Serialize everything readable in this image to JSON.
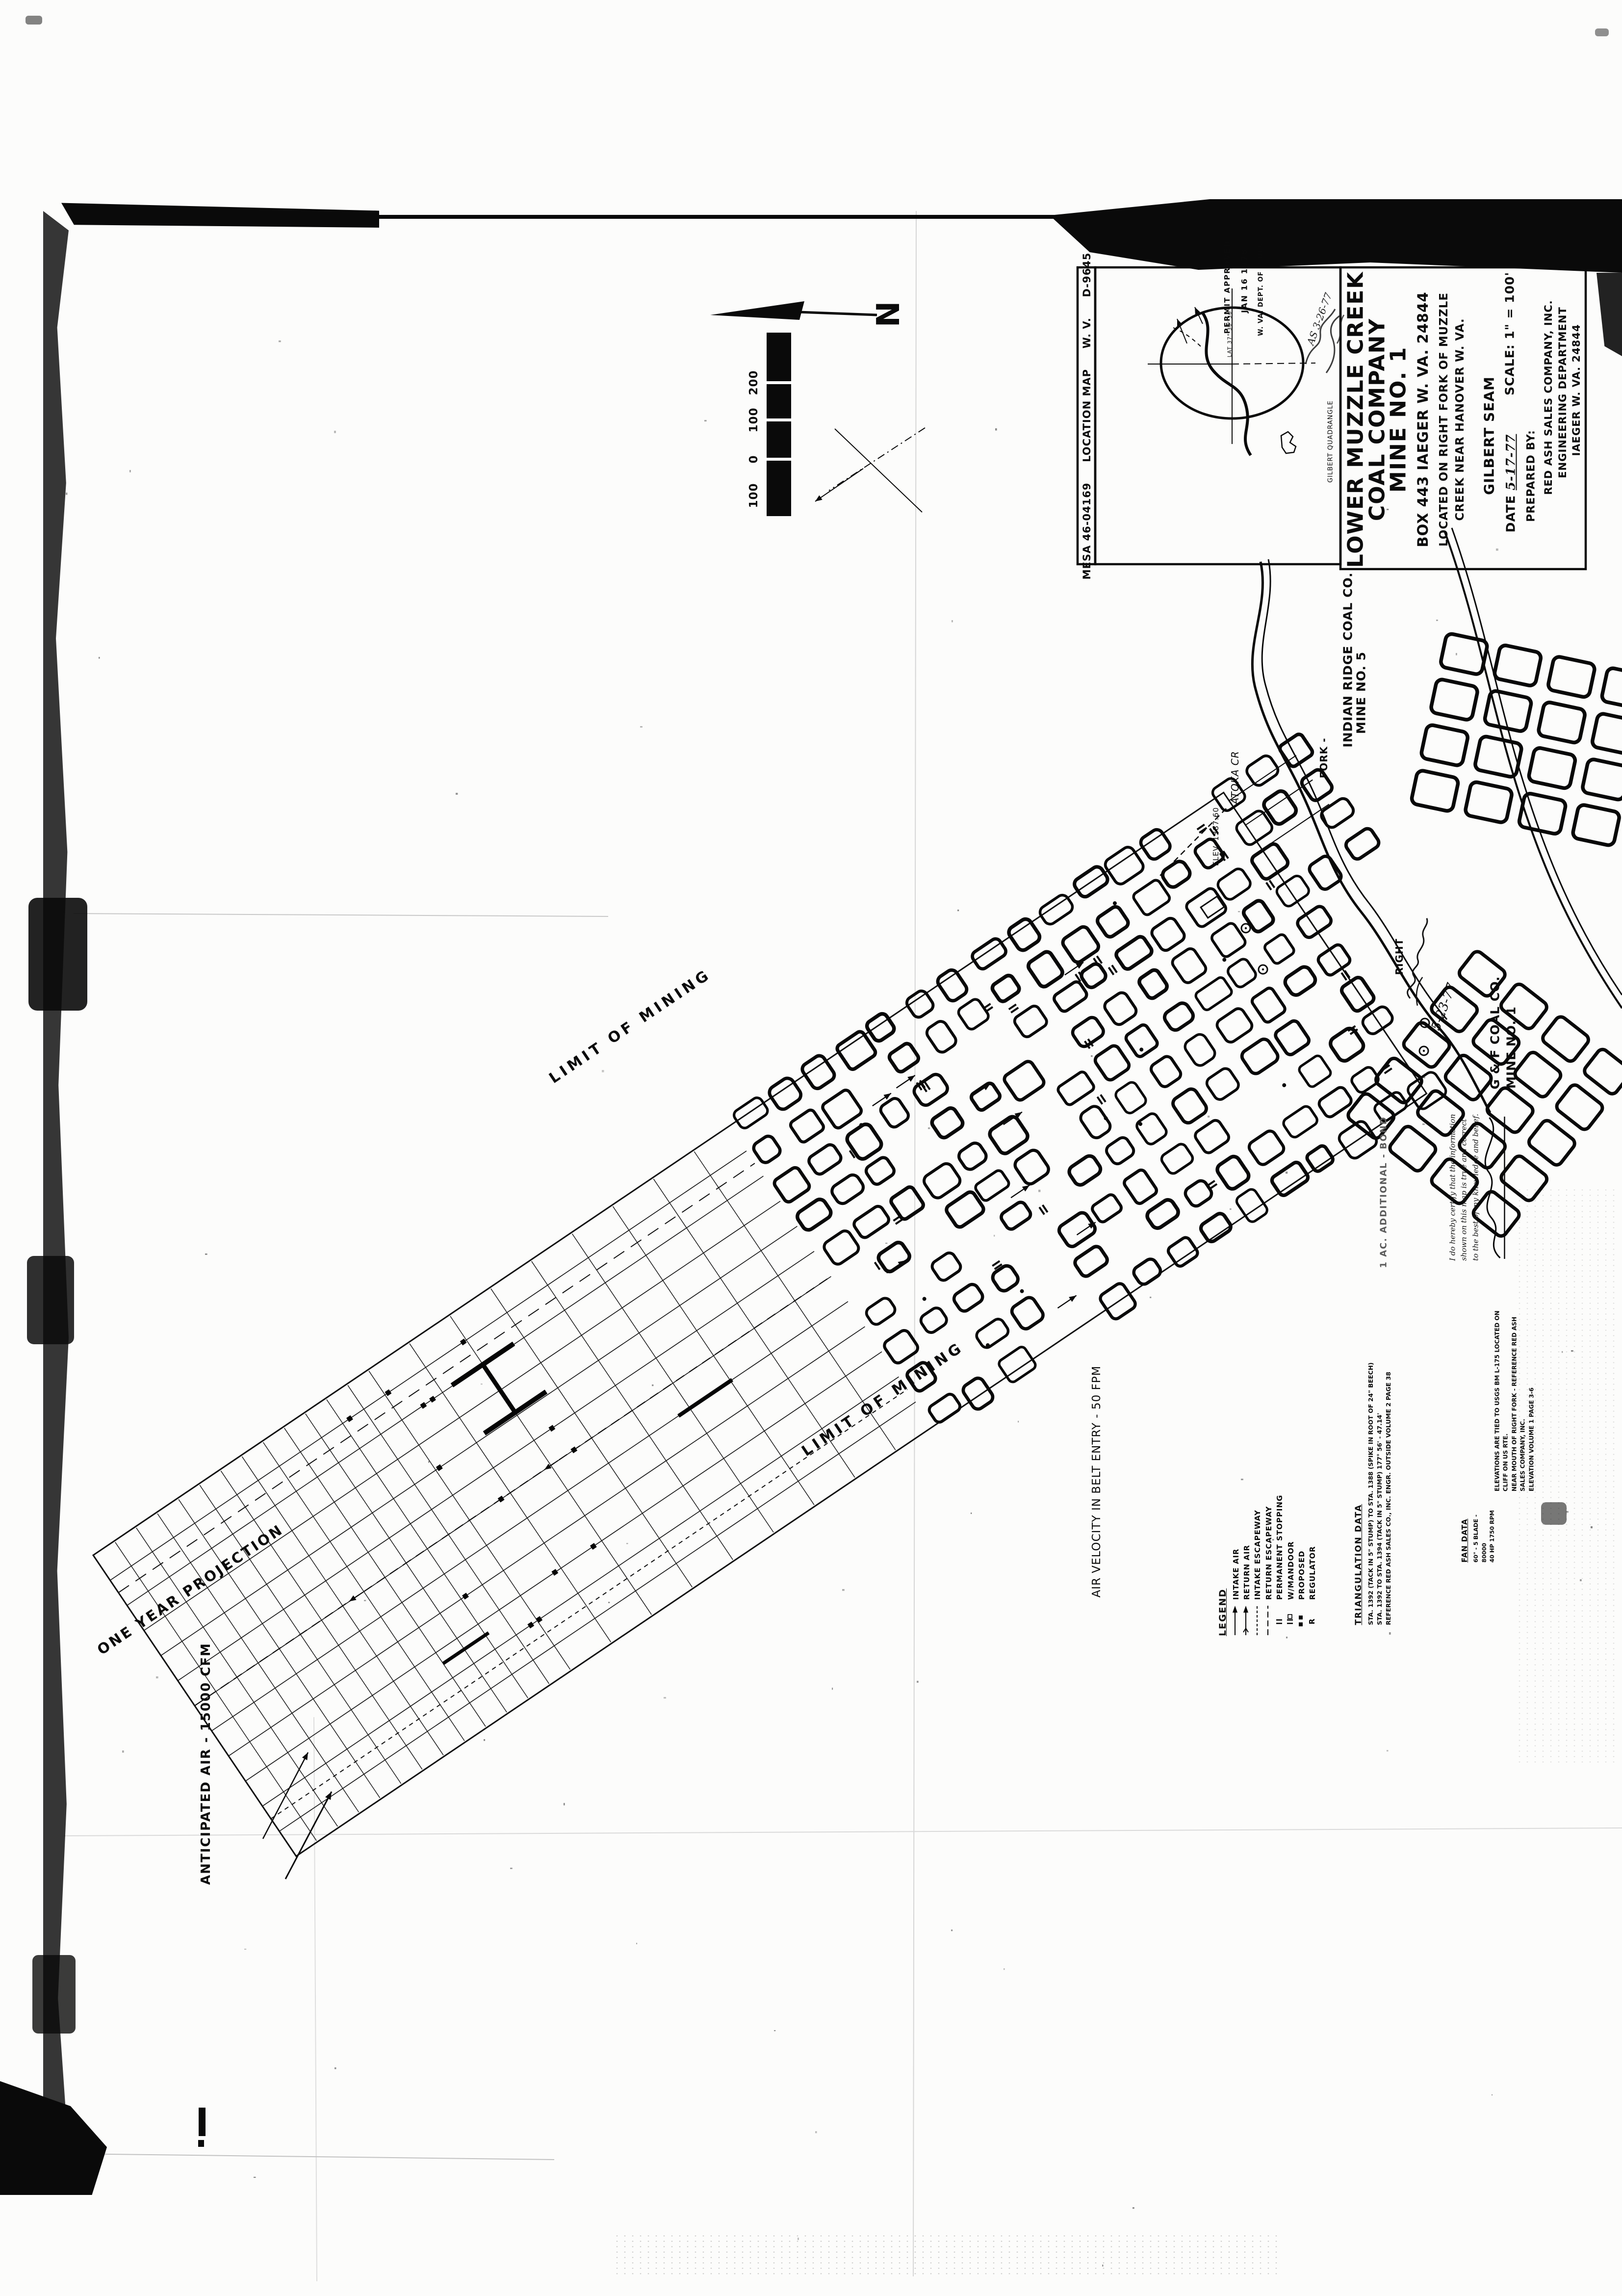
{
  "title_block": {
    "company_line1": "LOWER MUZZLE CREEK",
    "company_line2": "COAL COMPANY",
    "company_line3": "MINE NO. 1",
    "address": "BOX 443  IAEGER  W. VA.  24844",
    "located_line1": "LOCATED ON RIGHT FORK OF MUZZLE",
    "located_line2": "CREEK NEAR HANOVER W. VA.",
    "seam": "GILBERT SEAM",
    "date_label": "DATE",
    "date_value": "5-17-77",
    "scale_label": "SCALE:",
    "scale_value": "1\" = 100'",
    "prepared_by_label": "PREPARED BY:",
    "prepared_by_line1": "RED ASH SALES COMPANY, INC.",
    "prepared_by_line2": "ENGINEERING DEPARTMENT",
    "prepared_by_line3": "IAEGER  W. VA.  24844"
  },
  "index_strip": {
    "agency_number": "MESA 46-04169",
    "map_type": "LOCATION MAP",
    "state": "W. V.",
    "drawing_number": "D-9645",
    "quadrangle": "GILBERT QUADRANGLE"
  },
  "stamp": {
    "line1": "PERMIT APPROVED",
    "line2": "JAN 16 1978",
    "line3": "W. VA. DEPT. OF MINES",
    "lat_note": "LAT 37° 30' 30\"",
    "pencil_note": "AS 3-26-77"
  },
  "compass": {
    "north_label": "N",
    "scale_bar_labels": [
      "200",
      "100",
      "0",
      "100"
    ]
  },
  "map_labels": {
    "limit_of_mining": "LIMIT OF MINING",
    "one_year_projection": "ONE YEAR PROJECTION",
    "anticipated_air": "ANTICIPATED AIR - 15000 CFM",
    "air_velocity": "AIR VELOCITY IN BELT ENTRY - 50 FPM",
    "creek_upper": "ATOKA CR",
    "creek_fork": "FORK -",
    "creek_right": "RIGHT",
    "portal_elevation": "ELEV. 1387.60",
    "additional_bond_note": "1 AC. ADDITIONAL - BOND",
    "signature_date": "5-23-77"
  },
  "neighbor_mines": {
    "indian_ridge_line1": "INDIAN RIDGE COAL CO.",
    "indian_ridge_line2": "MINE NO. 5",
    "gf_line1": "G & F COAL CO.",
    "gf_line2": "MINE NO. 1"
  },
  "legend": {
    "title": "LEGEND",
    "items": [
      {
        "symbol": "arrow-single",
        "label": "INTAKE AIR"
      },
      {
        "symbol": "arrow-double",
        "label": "RETURN AIR"
      },
      {
        "symbol": "dash-short",
        "label": "INTAKE ESCAPEWAY"
      },
      {
        "symbol": "dash-long",
        "label": "RETURN ESCAPEWAY"
      },
      {
        "symbol": "double-bar",
        "label": "PERMANENT STOPPING"
      },
      {
        "symbol": "double-bar-door",
        "label": "W/MANDOOR"
      },
      {
        "symbol": "solid-squares",
        "label": "PROPOSED"
      },
      {
        "symbol": "letter-r",
        "label": "REGULATOR"
      }
    ]
  },
  "notes": {
    "triangulation_title": "TRIANGULATION DATA",
    "triangulation_lines": [
      "STA. 1392 (TACK IN 5\" STUMP) TO STA. 1388 (SPIKE IN ROOT OF 24\" BEECH)",
      "STA. 1392 TO STA. 1394 (TACK IN 5\" STUMP) 177° 56' - 47.14'",
      "REFERENCE RED ASH SALES CO., INC.   ENGR. OUTSIDE VOLUME 2 PAGE 38"
    ],
    "elevations_lines": [
      "ELEVATIONS ARE TIED TO USGS BM L-175 LOCATED ON CLIFF ON US RTE.",
      "NEAR MOUTH OF RIGHT FORK - REFERENCE RED ASH SALES COMPANY, INC.",
      "ELEVATION VOLUME 1 PAGE 3-6"
    ],
    "fan_title": "FAN DATA",
    "fan_lines": [
      "60\" - 5 BLADE - 80000",
      "40 HP   1750 RPM"
    ],
    "certification_lines": [
      "I do hereby certify that the information",
      "shown on this map is true and correct",
      "to the best of my knowledge and belief."
    ]
  }
}
